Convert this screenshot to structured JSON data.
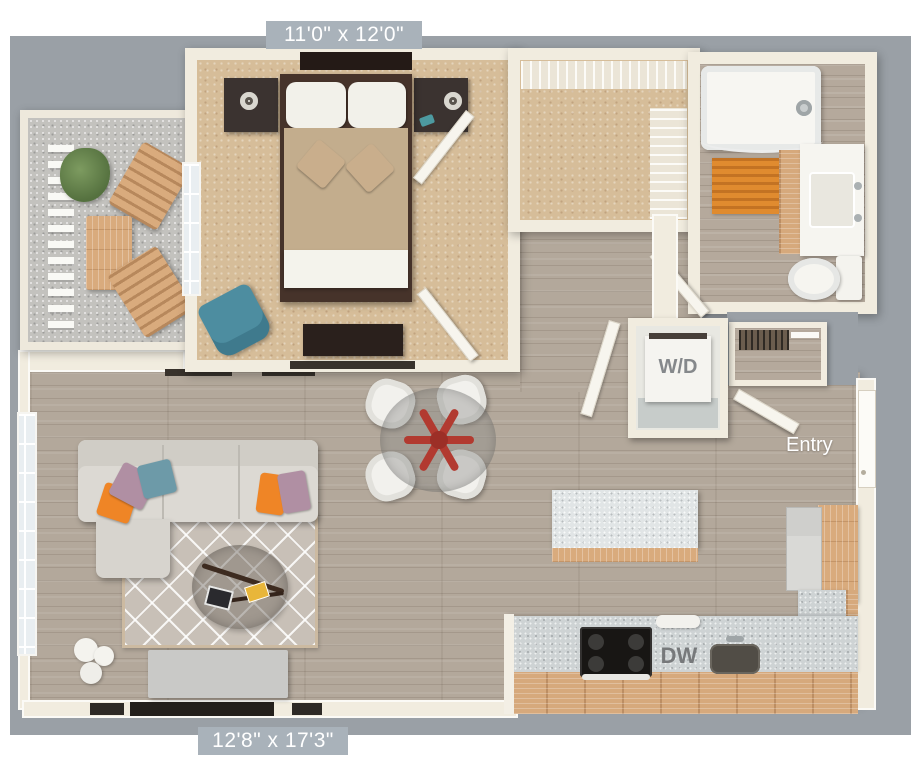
{
  "floorplan": {
    "kind": "apartment-3d-floorplan",
    "labels": {
      "bedroom_dims": "11'0\" x 12'0\"",
      "living_dims": "12'8\" x 17'3\"",
      "washer_dryer": "W/D",
      "dishwasher": "DW",
      "entry": "Entry"
    },
    "colors": {
      "background_gray": "#9aa0a6",
      "label_badge": "#a9b2ba",
      "wall_cream": "#f1ecdf",
      "carpet_tan": "#d6bd99",
      "wood_floor": "#b3a89b",
      "cabinet_wood": "#d9ab7d",
      "counter_gray": "#ced3d4",
      "accent_orange": "#ef8526",
      "accent_teal": "#4d8da0",
      "accent_mauve": "#b08fa3",
      "accent_red": "#b23a30",
      "bath_mat_orange": "#e08b2f"
    }
  }
}
